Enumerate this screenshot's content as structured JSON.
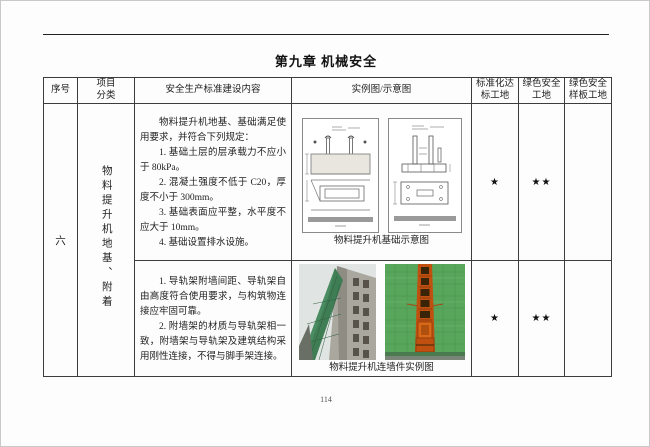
{
  "page": {
    "chapter_title": "第九章  机械安全",
    "page_number": "114"
  },
  "table": {
    "headers": {
      "col1": "序号",
      "col2": "项目\n分类",
      "col3": "安全生产标准建设内容",
      "col4": "实例图/示意图",
      "col5": "标准化达标工地",
      "col6": "绿色安全工地",
      "col7": "绿色安全样板工地"
    },
    "group": {
      "index": "六",
      "category": "物料提升机地基、附着",
      "rows": [
        {
          "paragraphs": [
            "物料提升机地基、基础满足使用要求，并符合下列规定：",
            "1. 基础土层的层承载力不应小于 80kPa。",
            "2. 混凝土强度不低于 C20，厚度不小于 300mm。",
            "3. 基础表面应平整，水平度不应大于 10mm。",
            "4. 基础设置排水设施。"
          ],
          "image_caption": "物料提升机基础示意图",
          "ratings": {
            "standard": "★",
            "green": "★★",
            "model": ""
          }
        },
        {
          "paragraphs": [
            "1. 导轨架附墙间距、导轨架自由高度符合使用要求，与构筑物连接应牢固可靠。",
            "2. 附墙架的材质与导轨架相一致，附墙架与导轨架及建筑结构采用刚性连接，不得与脚手架连接。"
          ],
          "image_caption": "物料提升机连墙件实例图",
          "ratings": {
            "standard": "★",
            "green": "★★",
            "model": ""
          }
        }
      ]
    }
  },
  "colors": {
    "mesh_green": "#58a55c",
    "tower_orange": "#c05010",
    "net_teal": "#3f7d55",
    "concrete_gray": "#aaa79e"
  }
}
